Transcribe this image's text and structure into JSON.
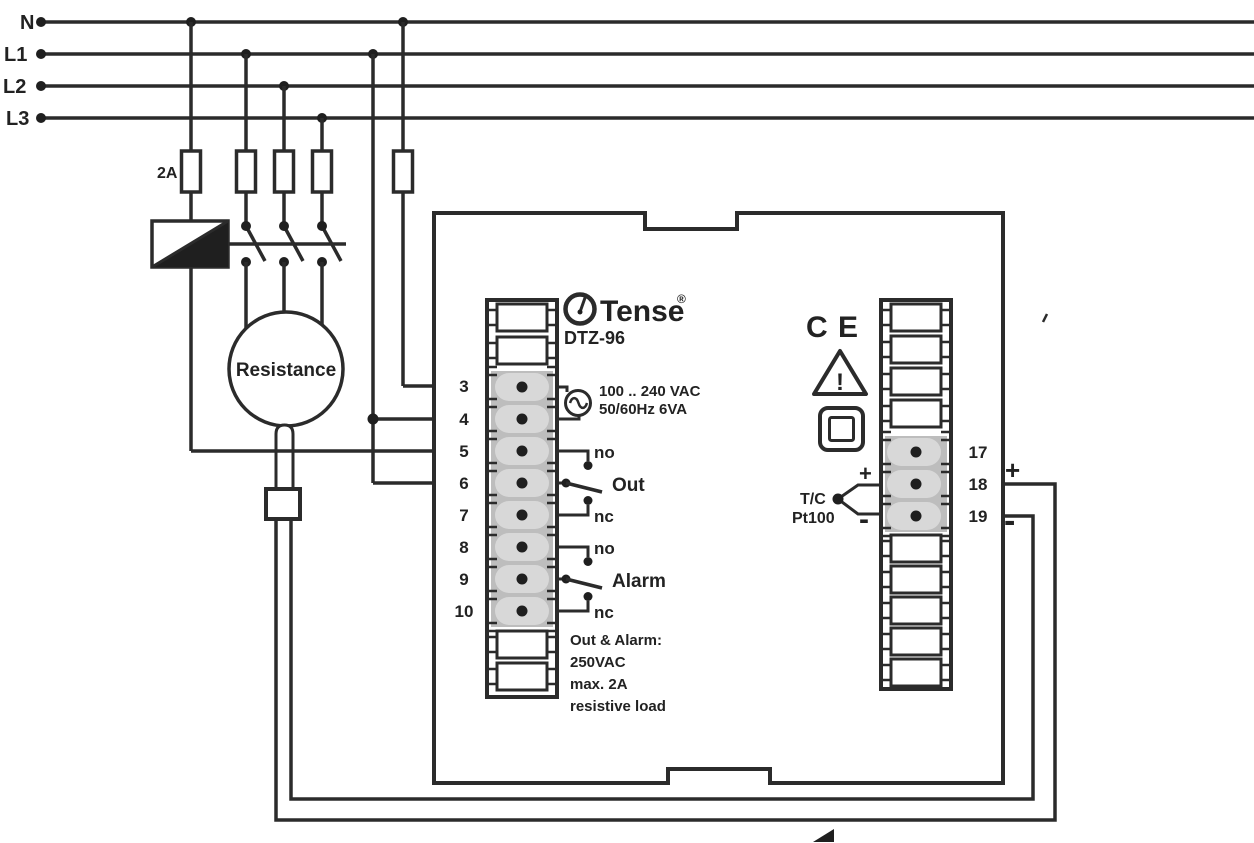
{
  "diagram_title": "DTZ-96 temperature controller wiring diagram",
  "colors": {
    "background": "#ffffff",
    "wire": "#2b2b2b",
    "terminal_block": "#bdbdbd",
    "terminal_cell": "#d8d8d8"
  },
  "bus": {
    "labels": [
      "N",
      "L1",
      "L2",
      "L3"
    ]
  },
  "fuse_label": "2A",
  "load": {
    "label": "Resistance"
  },
  "device": {
    "brand": "Tense",
    "reg_mark": "®",
    "model": "DTZ-96",
    "supply_line1": "100 .. 240 VAC",
    "supply_line2": "50/60Hz 6VA",
    "out_no": "no",
    "out_label": "Out",
    "out_nc": "nc",
    "alarm_no": "no",
    "alarm_label": "Alarm",
    "alarm_nc": "nc",
    "rating_line1": "Out & Alarm:",
    "rating_line2": "250VAC",
    "rating_line3": "max. 2A",
    "rating_line4": "resistive load",
    "left_terminals": [
      "3",
      "4",
      "5",
      "6",
      "7",
      "8",
      "9",
      "10"
    ],
    "right_terminals": [
      "17",
      "18",
      "19"
    ],
    "ce": "C E",
    "warning": "!",
    "sensor_type1": "T/C",
    "sensor_type2": "Pt100",
    "sensor_plus": "+",
    "sensor_minus": "-",
    "ext_plus": "+",
    "ext_minus": "-"
  }
}
